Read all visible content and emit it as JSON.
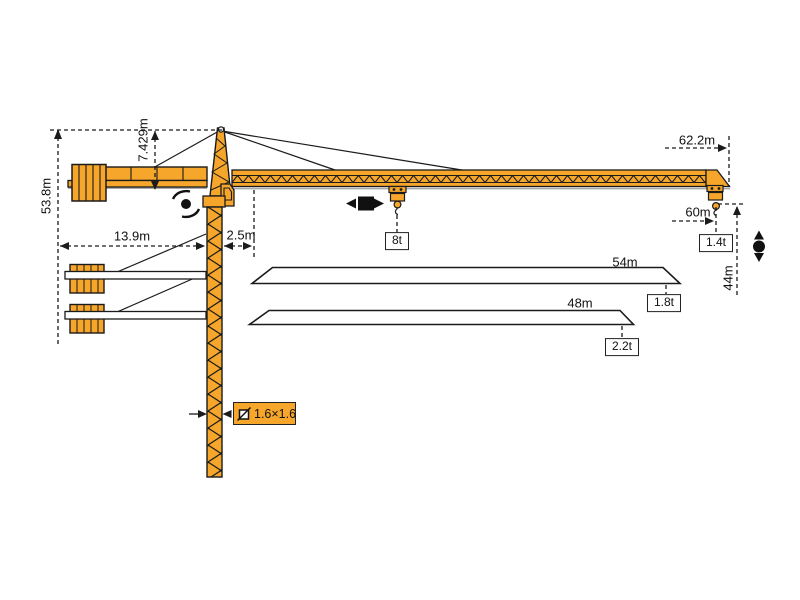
{
  "diagram": {
    "type": "tower-crane-specification-diagram",
    "colors": {
      "crane": "#F6A62B",
      "outline": "#1b1b1b",
      "shadow": "#a9a9a9",
      "label_box": "#ffffff"
    },
    "labels": {
      "total_height": "53.8m",
      "head_height": "7.429m",
      "counter_jib_length": "13.9m",
      "slew_offset": "2.5m",
      "jib_length_max": "62.2m",
      "working_radius": "60m",
      "tip_load_60m": "1.4t",
      "max_load": "8t",
      "jib_length_54": "54m",
      "tip_load_54m": "1.8t",
      "jib_length_48": "48m",
      "tip_load_48m": "2.2t",
      "hook_height": "44m",
      "mast_section": "1.6×1.6"
    },
    "jib_variants": [
      {
        "length": "54m",
        "tip_load": "1.8t"
      },
      {
        "length": "48m",
        "tip_load": "2.2t"
      }
    ],
    "icons": {
      "slewing": "slewing-rotation-icon",
      "trolley": "trolley-travel-icon",
      "hoist": "hook-hoist-icon"
    }
  }
}
